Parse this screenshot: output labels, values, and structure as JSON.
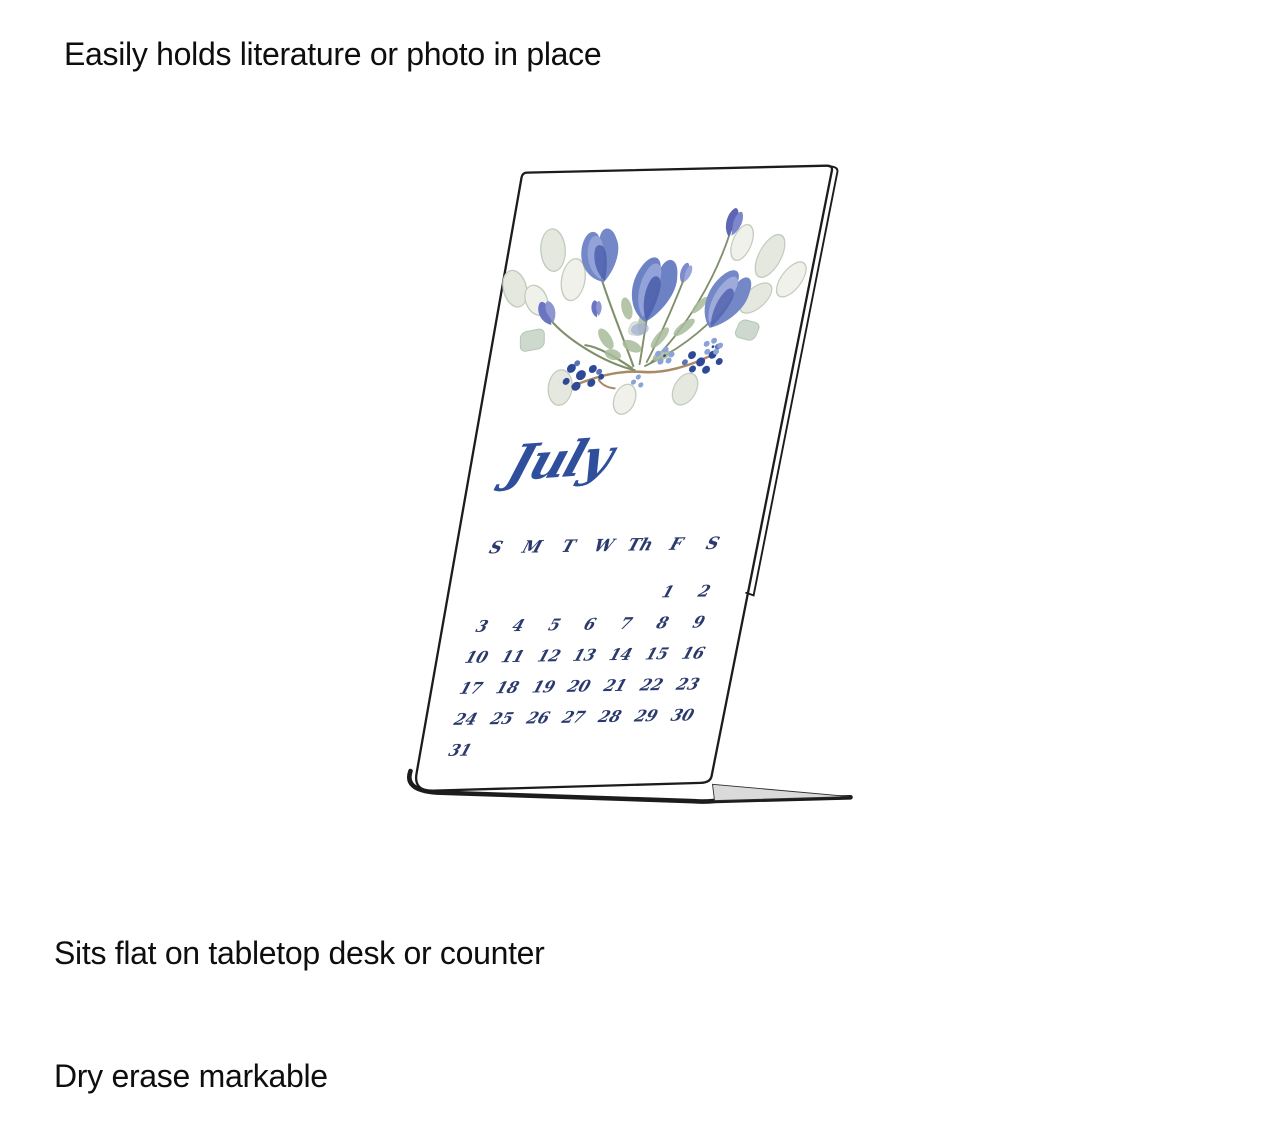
{
  "product_labels": {
    "top_caption": "Easily holds literature or photo in place",
    "bottom_caption_line1": "Sits flat on tabletop desk or counter",
    "bottom_caption_line2": "Dry erase markable"
  },
  "calendar": {
    "month": "July",
    "weekdays": [
      "S",
      "M",
      "T",
      "W",
      "Th",
      "F",
      "S"
    ],
    "weeks": [
      [
        "",
        "",
        "",
        "",
        "",
        "1",
        "2"
      ],
      [
        "3",
        "4",
        "5",
        "6",
        "7",
        "8",
        "9"
      ],
      [
        "10",
        "11",
        "12",
        "13",
        "14",
        "15",
        "16"
      ],
      [
        "17",
        "18",
        "19",
        "20",
        "21",
        "22",
        "23"
      ],
      [
        "24",
        "25",
        "26",
        "27",
        "28",
        "29",
        "30"
      ],
      [
        "31",
        "",
        "",
        "",
        "",
        "",
        ""
      ]
    ],
    "ink_color": "#2b3a6e",
    "month_color": "#2f4e9b"
  },
  "artwork_colors": {
    "flower_blue": "#7487c6",
    "flower_blue_light": "#97a5da",
    "flower_blue_dark": "#4d60ad",
    "bud_purple": "#5d66b5",
    "leaf_pale": "#e4e8de",
    "leaf_pale_stroke": "#c2cbbd",
    "leaf_sage": "#a9bc9b",
    "leaf_mint": "#cdd9cd",
    "berry_navy": "#2e4a96",
    "floret_blue": "#8ba3d8",
    "twig_brown": "#a98a64",
    "stem_olive": "#72845c"
  },
  "stand_colors": {
    "edge": "#1c1c1c",
    "face": "#ffffff",
    "base_top": "#dadada"
  }
}
